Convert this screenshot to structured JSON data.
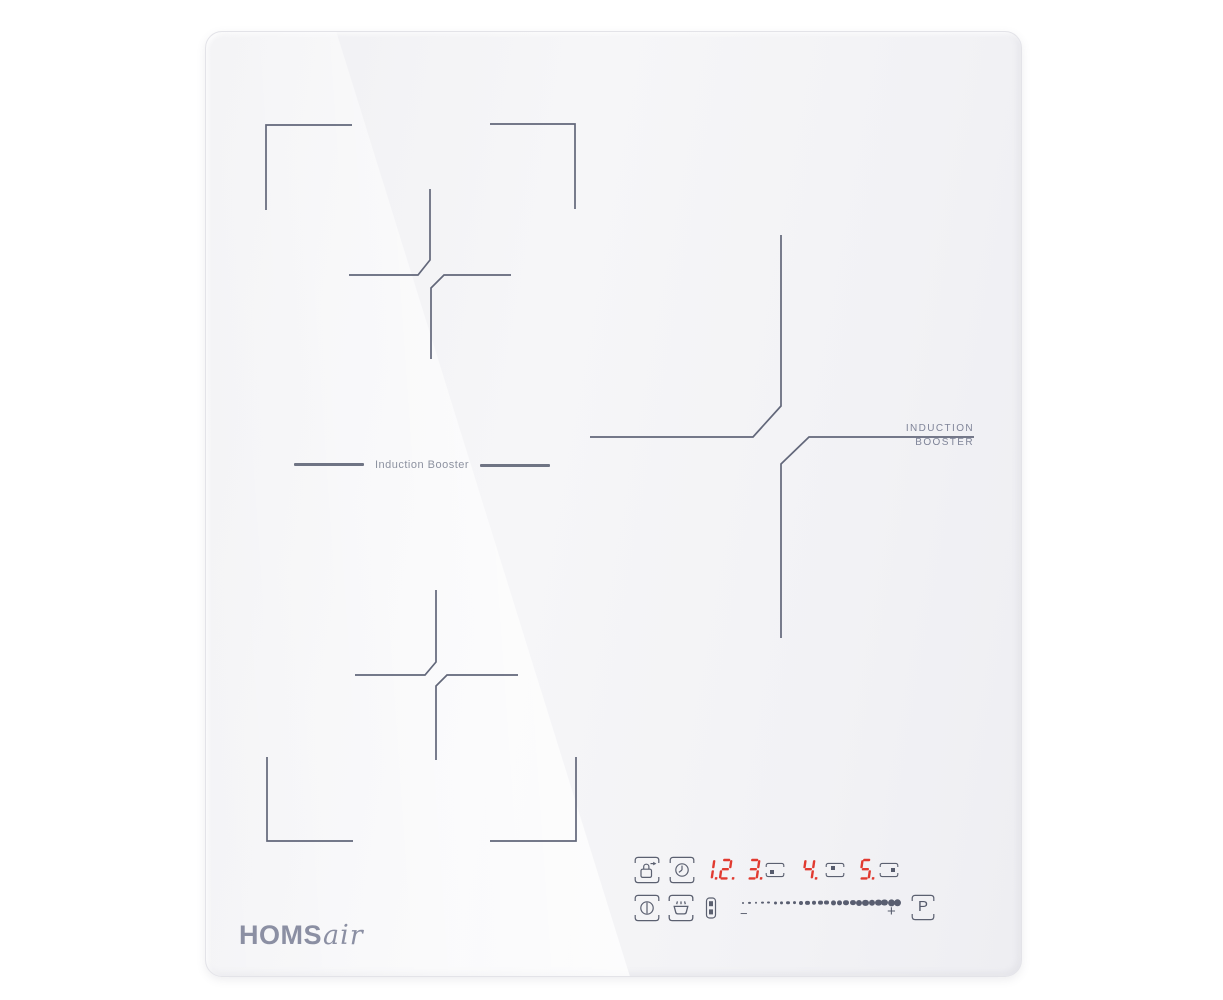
{
  "brand": {
    "wordmark_bold": "HOMS",
    "wordmark_script": "air"
  },
  "labels": {
    "left_zone_booster": "Induction Booster",
    "right_zone_booster_line1": "INDUCTION",
    "right_zone_booster_line2": "BOOSTER"
  },
  "display": {
    "led_color": "#e13a30",
    "digits": [
      "1.",
      "2.",
      "3.",
      "4.",
      "5."
    ],
    "zone_position_indicators": [
      {
        "follows": "3.",
        "dot": "bottom-left"
      },
      {
        "follows": "4.",
        "dot": "top-left"
      },
      {
        "follows": "5.",
        "dot": "middle-right"
      }
    ]
  },
  "controls": {
    "icons": [
      "child-lock",
      "timer",
      "power",
      "keep-warm",
      "bridge-zone"
    ],
    "power_slider": {
      "minus_label": "−",
      "plus_label": "+",
      "dot_count": 25
    },
    "booster_button_label": "P"
  },
  "colors": {
    "surface": "#f4f4f6",
    "zone_marking": "#62677a",
    "icon": "#5b6070",
    "led": "#e13a30",
    "logo": "#8b8fa3"
  }
}
